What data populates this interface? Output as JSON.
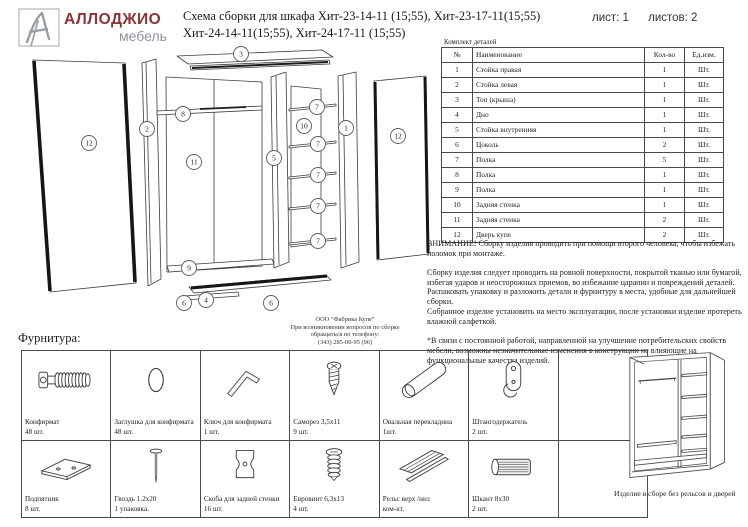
{
  "header": {
    "brand_name": "АЛЛОДЖИО",
    "brand_sub": "мебель",
    "title_line1": "Схема сборки для шкафа Хит-23-14-11 (15;55), Хит-23-17-11(15;55)",
    "title_line2": "Хит-24-14-11(15;55), Хит-24-17-11 (15;55)",
    "sheet_label": "лист: 1",
    "sheets_label": "листов: 2"
  },
  "diagram": {
    "callouts": [
      {
        "n": "3",
        "x": 241,
        "y": 54
      },
      {
        "n": "12",
        "x": 89,
        "y": 143
      },
      {
        "n": "2",
        "x": 147,
        "y": 129
      },
      {
        "n": "8",
        "x": 183,
        "y": 114
      },
      {
        "n": "11",
        "x": 194,
        "y": 162
      },
      {
        "n": "7",
        "x": 317,
        "y": 107
      },
      {
        "n": "10",
        "x": 304,
        "y": 126
      },
      {
        "n": "1",
        "x": 346,
        "y": 128
      },
      {
        "n": "12",
        "x": 398,
        "y": 136
      },
      {
        "n": "5",
        "x": 274,
        "y": 158
      },
      {
        "n": "7",
        "x": 318,
        "y": 144
      },
      {
        "n": "7",
        "x": 318,
        "y": 175
      },
      {
        "n": "7",
        "x": 318,
        "y": 206
      },
      {
        "n": "7",
        "x": 318,
        "y": 241
      },
      {
        "n": "9",
        "x": 189,
        "y": 268
      },
      {
        "n": "6",
        "x": 184,
        "y": 303
      },
      {
        "n": "4",
        "x": 206,
        "y": 300
      },
      {
        "n": "6",
        "x": 271,
        "y": 303
      }
    ]
  },
  "factory": {
    "line1": "ООО \"Фабрика Купе\"",
    "line2": "При возникновении вопросов по сборке",
    "line3": "обращаться по телефону:",
    "line4": "(343) 285-00-95 (96)"
  },
  "parts_table": {
    "caption": "Комплект деталей",
    "columns": [
      "№",
      "Наименование",
      "Кол-во",
      "Ед.изм."
    ],
    "rows": [
      [
        "1",
        "Стойка правая",
        "1",
        "Шт."
      ],
      [
        "2",
        "Стойка левая",
        "1",
        "Шт."
      ],
      [
        "3",
        "Топ (крыша)",
        "1",
        "Шт."
      ],
      [
        "4",
        "Дно",
        "1",
        "Шт."
      ],
      [
        "5",
        "Стойка внутренняя",
        "1",
        "Шт."
      ],
      [
        "6",
        "Цоколь",
        "2",
        "Шт."
      ],
      [
        "7",
        "Полка",
        "5",
        "Шт."
      ],
      [
        "8",
        "Полка",
        "1",
        "Шт."
      ],
      [
        "9",
        "Полка",
        "1",
        "Шт."
      ],
      [
        "10",
        "Задняя стенка",
        "1",
        "Шт."
      ],
      [
        "11",
        "Задняя стенка",
        "2",
        "Шт."
      ],
      [
        "12",
        "Дверь купе",
        "2",
        "Шт."
      ]
    ]
  },
  "notes": {
    "paragraphs": [
      "ВНИМАНИЕ! Сборку изделия проводить при помощи второго человека, чтобы избежать поломок при монтаже.",
      "Сборку изделия следует проводить на ровной поверхности, покрытой тканью или бумагой, избегая ударов и неосторожных приемов, во избежание царапин и повреждений деталей.",
      "Распаковать упаковку и разложить детали и фурнитуру в места, удобные для дальнейшей сборки.",
      "Собранное изделие установить на место эксплуатации, после установки изделие протереть влажной салфеткой.",
      "*В связи с постоянной работой, направленной на улучшение потребительских свойств мебели, возможны незначительные изменения в конструкции не влияющие на функциональные качества изделий."
    ]
  },
  "hardware": {
    "section_label": "Фурнитура:",
    "items": [
      {
        "icon": "confirmat-icon",
        "name": "Конфирмат",
        "qty": "48 шт."
      },
      {
        "icon": "plug-icon",
        "name": "Заглушка для конфирмата",
        "qty": "48 шт."
      },
      {
        "icon": "hex-key-icon",
        "name": "Ключ для конфирмата",
        "qty": "1 шт."
      },
      {
        "icon": "screw-icon",
        "name": "Саморез 3,5х11",
        "qty": "9 шт."
      },
      {
        "icon": "oval-bar-icon",
        "name": "Овальная перекладина",
        "qty": "1шт."
      },
      {
        "icon": "rod-holder-icon",
        "name": "Штангодержатель",
        "qty": "2 шт."
      },
      null,
      {
        "icon": "foot-pad-icon",
        "name": "Подпятник",
        "qty": "8 шт."
      },
      {
        "icon": "nail-icon",
        "name": "Гвоздь 1.2х20",
        "qty": "1 упаковка."
      },
      {
        "icon": "bracket-icon",
        "name": "Скоба для задней стенки",
        "qty": "16 шт."
      },
      {
        "icon": "euro-screw-icon",
        "name": "Евровинт 6,3х13",
        "qty": "4 шт."
      },
      {
        "icon": "rail-icon",
        "name": "Рельс верх /низ",
        "qty": "ком-кт."
      },
      {
        "icon": "dowel-icon",
        "name": "Шкант 8х30",
        "qty": "2 шт."
      }
    ]
  },
  "assembled": {
    "caption": "Изделие в сборе без рельсов и дверей"
  }
}
